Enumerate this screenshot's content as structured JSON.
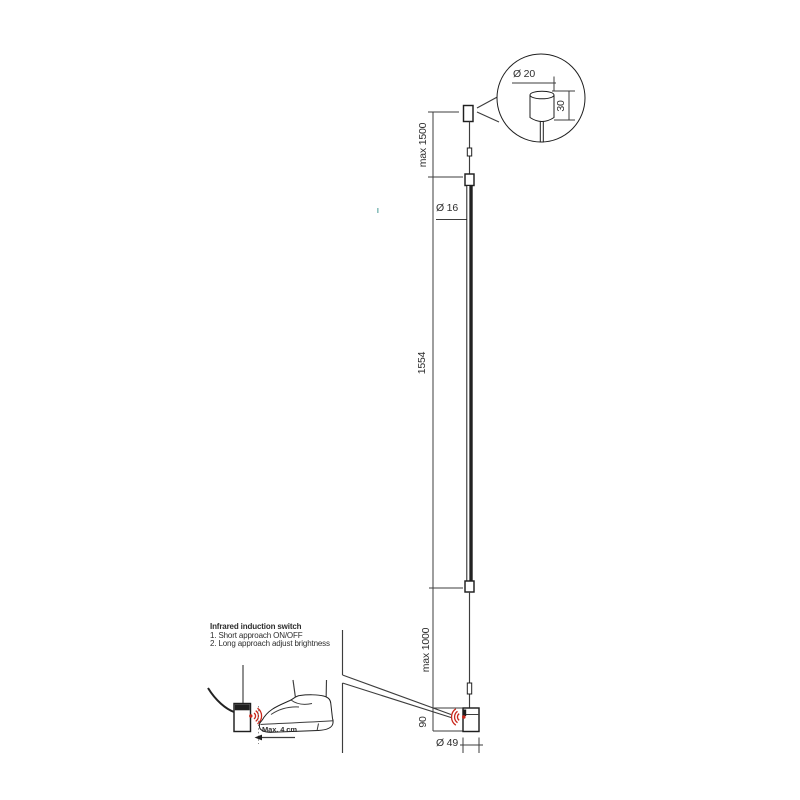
{
  "page": {
    "background": "#ffffff",
    "type": "pendant-lamp-technical-drawing"
  },
  "colors": {
    "line": "#3d3d3d",
    "dark": "#1f1f1f",
    "sensor_red": "#c9281c",
    "muted": "#8a8a8a"
  },
  "dimensions": {
    "suspension_max": "max 1500",
    "tube_diameter": "Ø 16",
    "tube_length": "1554",
    "cable_max": "max 1000",
    "head_height": "90",
    "head_diameter": "Ø 49",
    "canopy_diameter": "Ø 20",
    "canopy_height": "30"
  },
  "sensor_note": {
    "title": "Infrared induction switch",
    "item1": "1. Short approach ON/OFF",
    "item2": "2. Long approach adjust brightness",
    "distance_label": "Max. 4 cm"
  }
}
